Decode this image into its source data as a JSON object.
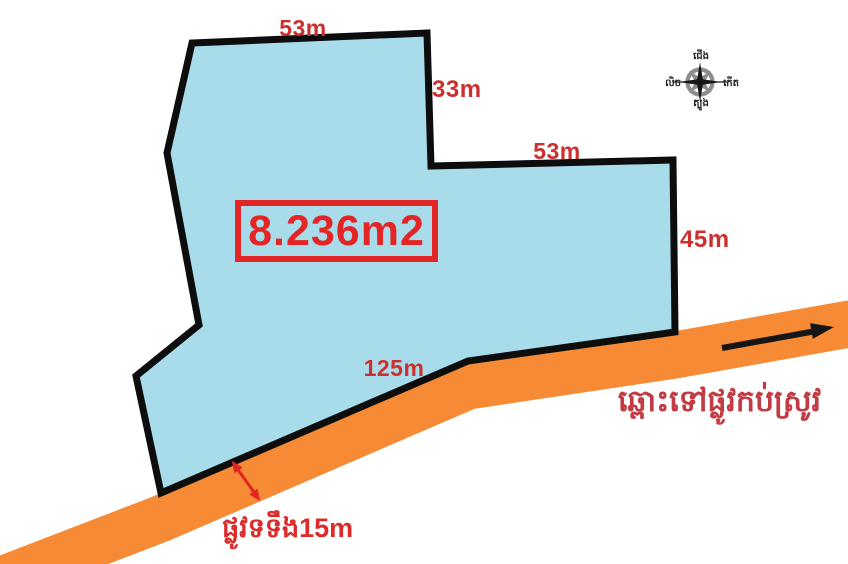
{
  "diagram": {
    "area_label": "8.236m2",
    "dimensions": {
      "top": "53m",
      "upper_right": "33m",
      "middle": "53m",
      "right": "45m",
      "bottom": "125m"
    },
    "road_direction_label": "ឆ្ពោះទៅផ្លូវកប់ស្រូវ",
    "road_width_label": "ផ្លូវទទឹង15m"
  },
  "compass": {
    "north": "ជើង",
    "south": "ត្បូង",
    "east": "កើត",
    "west": "លិច"
  },
  "colors": {
    "parcel_fill": "#a9dceb",
    "parcel_stroke": "#0d0d0d",
    "road_orange": "#f68a35",
    "dimension_red": "#cd2e2e",
    "area_red": "#e42525",
    "road_label_red": "#c23b44",
    "width_label_red": "#dd2b2b",
    "arrow_black": "#161616",
    "arrow_red": "#e02525",
    "compass_gray": "#8d8d8d"
  }
}
